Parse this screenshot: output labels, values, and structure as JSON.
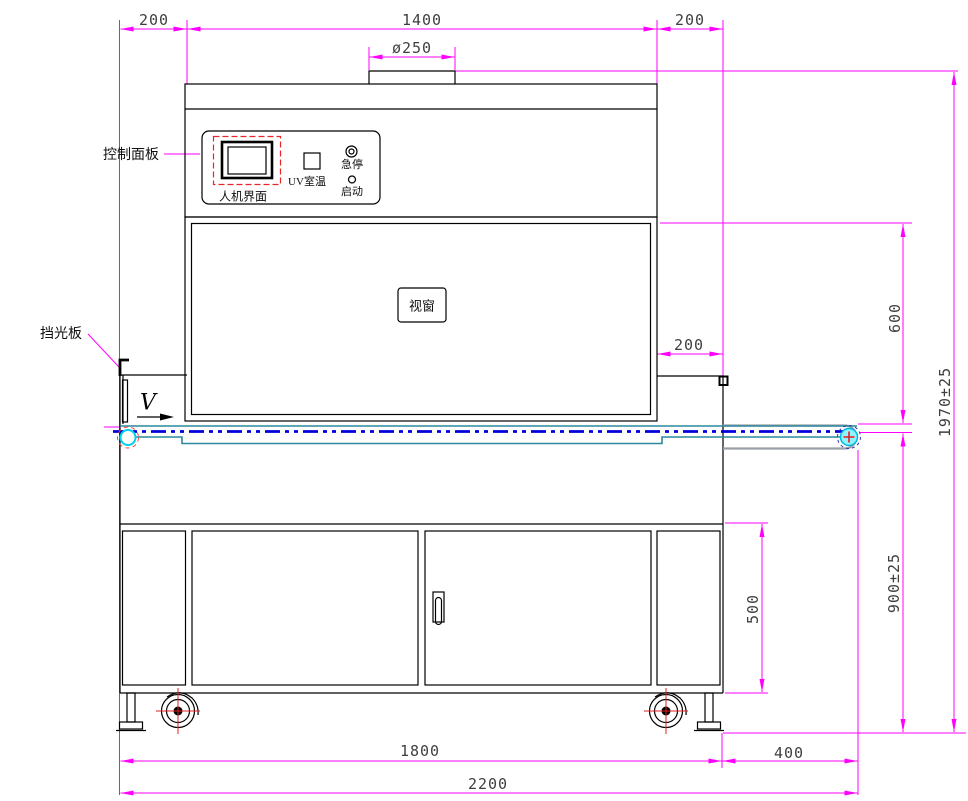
{
  "drawing_title": "UV curing conveyor machine - front view engineering drawing",
  "labels": {
    "control_panel": "控制面板",
    "hmi": "人机界面",
    "uv_room_temp": "UV室温",
    "emergency_stop": "急停",
    "start": "启动",
    "viewport": "视窗",
    "light_shield": "挡光板",
    "belt_speed": "V"
  },
  "dimensions": {
    "top_left_margin": "200",
    "top_body_width": "1400",
    "top_right_margin": "200",
    "duct_diameter": "ø250",
    "right_overhang": "200",
    "window_section_height": "600",
    "belt_working_height": "900±25",
    "overall_height": "1970±25",
    "door_height": "500",
    "body_width": "1800",
    "conveyor_extension": "400",
    "overall_width": "2200"
  },
  "colors": {
    "dimension_line": "#FF00FF",
    "belt_centerline": "#0000DD",
    "conveyor_frame": "#2B8A9D",
    "roller_cyan": "#00D0F0",
    "alert_red": "#E02020",
    "outline": "#000000"
  }
}
